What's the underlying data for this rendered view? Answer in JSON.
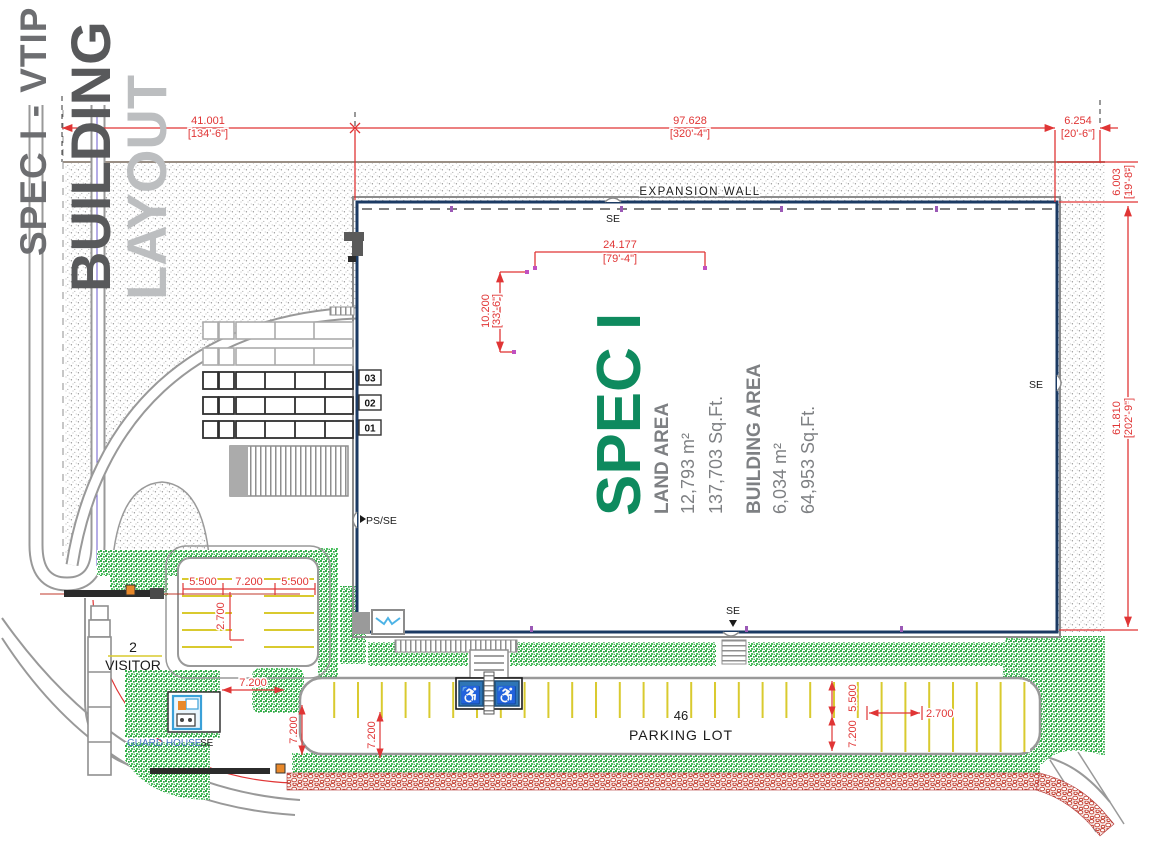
{
  "drawing_title": {
    "line1": "SPEC I - VTIP",
    "line2": "BUILDING",
    "line3": "LAYOUT"
  },
  "building": {
    "name": "SPEC I",
    "expansion_wall": "EXPANSION WALL",
    "land_area_label": "LAND AREA",
    "land_area_metric": "12,793 m²",
    "land_area_imperial": "137,703 Sq.Ft.",
    "building_area_label": "BUILDING AREA",
    "building_area_metric": "6,034 m²",
    "building_area_imperial": "64,953 Sq.Ft."
  },
  "dimensions": {
    "site_width_left": "41.001",
    "site_width_left_ft": "[134'-6\"]",
    "site_width_mid": "97.628",
    "site_width_mid_ft": "[320'-4\"]",
    "site_width_right": "6.254",
    "site_width_right_ft": "[20'-6\"]",
    "expansion_depth": "6.003",
    "expansion_depth_ft": "[19'-8\"]",
    "building_depth": "61.810",
    "building_depth_ft": "[202'-9\"]",
    "interior_width": "24.177",
    "interior_width_ft": "[79'-4\"]",
    "interior_depth": "10.200",
    "interior_depth_ft": "[33'-6\"]",
    "visitor_stall_left": "5.500",
    "visitor_aisle": "7.200",
    "visitor_stall_right": "5.500",
    "visitor_stall_width": "2.700",
    "yard_aisle": "7.200",
    "yard_road_a": "7.200",
    "yard_road_b": "7.200",
    "parking_stall_depth": "5.500",
    "parking_aisle": "7.200",
    "parking_stall_width": "2.700"
  },
  "labels": {
    "se": "SE",
    "ps_se": "PS/SE",
    "dock_01": "01",
    "dock_02": "02",
    "dock_03": "03",
    "visitor_count": "2",
    "visitor": "VISITOR",
    "parking_count": "46",
    "parking_lot": "PARKING LOT",
    "guard_house": "GUARD HOUSE",
    "ada_symbol": "♿"
  },
  "colors": {
    "accent_green": "#0e8a5e",
    "dimension_red": "#e03535",
    "building_outline": "#1b3a63",
    "landscape_green": "#33b34a",
    "stripe_yellow": "#d9ca2f",
    "title_dark": "#6d6e71",
    "title_light": "#bcbec0",
    "annotation_gray": "#808285"
  }
}
